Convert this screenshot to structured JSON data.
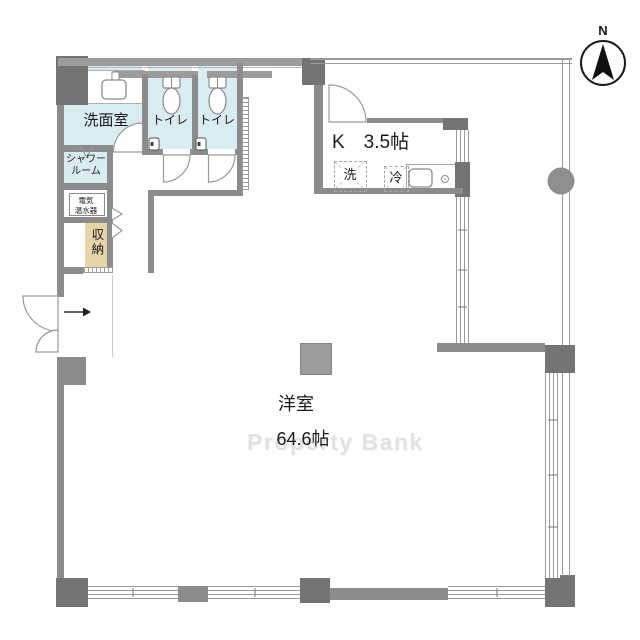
{
  "plan_type": "floorplan",
  "compass": {
    "label": "N"
  },
  "watermark": {
    "text": "Property Bank"
  },
  "rooms": {
    "washroom": {
      "label": "洗面室"
    },
    "toilet_a": {
      "label": "トイレ"
    },
    "toilet_b": {
      "label": "トイレ"
    },
    "shower": {
      "lines": [
        "シャワー",
        "ルーム"
      ]
    },
    "water_heater": {
      "lines": [
        "電気",
        "温水器"
      ]
    },
    "storage": {
      "label": "収納"
    },
    "kitchen": {
      "label": "K　3.5帖"
    },
    "living": {
      "label": "洋室",
      "size": "64.6帖"
    }
  },
  "fixtures": {
    "washer_label": "洗",
    "fridge_label": "冷"
  },
  "colors": {
    "wall": "#8c8c8c",
    "wall_dark": "#747474",
    "wall_light": "#9c9c9c",
    "room_blue": "#d9ecf1",
    "storage_tan": "#e7d4a7",
    "watermark": "#e2e2e2"
  }
}
